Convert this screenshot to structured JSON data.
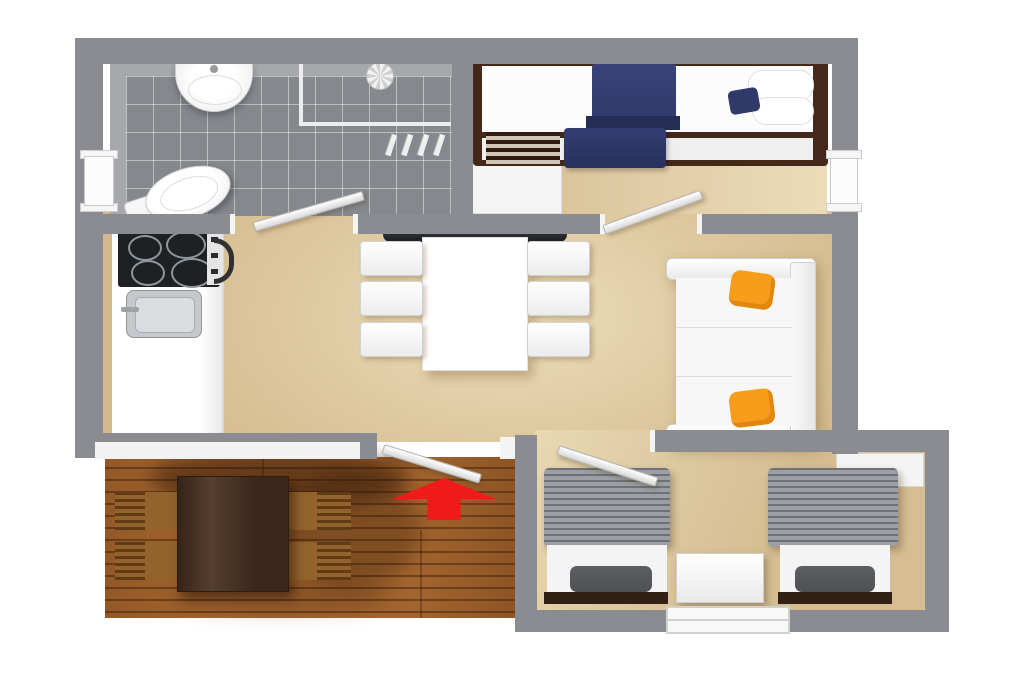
{
  "scene": {
    "type": "3d-floor-plan-top-view",
    "description": "Top-down 3D rendering of a small holiday home with bathroom, double bedroom, open kitchen-dining-living area, twin bedroom and wooden terrace; red arrow marks the entrance"
  },
  "colors": {
    "wall": "#8b8c91",
    "wall_face_light": "#a6a8ac",
    "jamb_white": "#f4f4f4",
    "floor_main": "#d9c197",
    "floor_light": "#eee0bd",
    "tile_floor": "#85888d",
    "deck_wood": "#a3652f",
    "deck_table_wood": "#4b3222",
    "chair_wood": "#93622d",
    "chair_slat": "#5f3c16",
    "appliance_dark": "#1e2023",
    "metal_gray": "#c6c9cc",
    "bed_wood_dark": "#44281a",
    "navy": "#2f3a68",
    "navy_dark": "#242e55",
    "orange": "#f89c1b",
    "blanket_gray": "#9ca0a5",
    "pillow_gray": "#4e5054",
    "foot_wood": "#332015",
    "sofa_white": "#f7f7f7",
    "arrow_red": "#ef1a1a"
  },
  "rooms": [
    {
      "id": "bathroom",
      "position": "top-left",
      "floor": "gray-tile",
      "furniture": [
        "wash-basin",
        "shower-head",
        "shower-pipes",
        "towel-hooks",
        "toilet"
      ]
    },
    {
      "id": "double-bedroom",
      "position": "top-right",
      "floor": "beige",
      "furniture": [
        "double-bed-dark-wood-frame",
        "navy-blue-blanket",
        "white-pillows",
        "navy-cushion",
        "slatted-bench",
        "white-cabinet"
      ]
    },
    {
      "id": "open-living-area",
      "position": "center",
      "floor": "beige",
      "furniture": [
        "kitchenette-counter",
        "four-burner-cooktop",
        "kitchen-sink",
        "wall-console",
        "dining-table",
        "dining-chair-x6",
        "white-sofa",
        "orange-cushion-x2"
      ]
    },
    {
      "id": "twin-bedroom",
      "position": "bottom-right",
      "floor": "beige",
      "furniture": [
        "single-bed-x2",
        "gray-striped-blanket-x2",
        "dark-pillow-x2",
        "nightstand",
        "wardrobe"
      ]
    },
    {
      "id": "terrace",
      "position": "bottom-left",
      "floor": "wood-deck",
      "furniture": [
        "wooden-dining-table",
        "wooden-slatted-chair-x4"
      ]
    }
  ],
  "openings": {
    "windows": [
      "left-wall",
      "right-wall",
      "twin-bedroom-south"
    ],
    "doors": [
      "bathroom-door",
      "double-bedroom-door",
      "main-entrance-door",
      "twin-bedroom-door"
    ]
  },
  "annotations": {
    "entrance_arrow": {
      "glyph": "up-arrow",
      "meaning": "entrance",
      "color": "#ef1a1a"
    }
  }
}
